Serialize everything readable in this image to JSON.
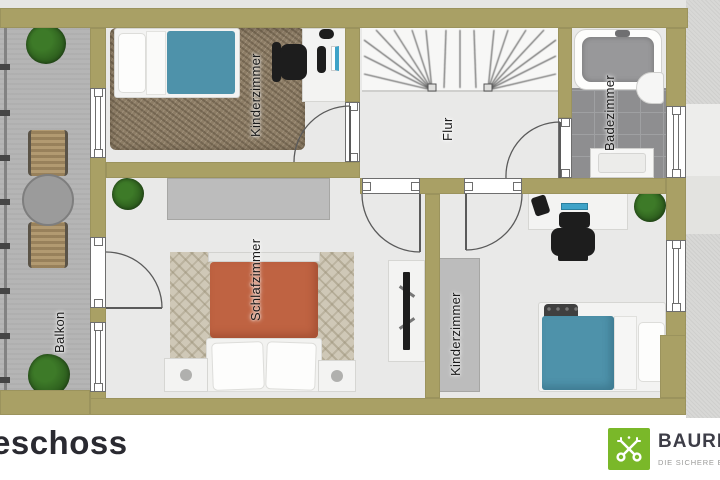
{
  "rooms": {
    "balcony": {
      "label": "Balkon"
    },
    "kids_room_top": {
      "label": "Kinderzimmer"
    },
    "hallway": {
      "label": "Flur"
    },
    "bathroom": {
      "label": "Badezimmer"
    },
    "bedroom": {
      "label": "Schlafzimmer"
    },
    "kids_room_bottom": {
      "label": "Kinderzimmer"
    }
  },
  "footer": {
    "floor_title": "eschoss",
    "logo": {
      "brand": "BAURI",
      "tagline": "DIE SICHERE EI",
      "emblem_icon": "crossed-keys-icon",
      "green": "#7ab829"
    }
  },
  "colors": {
    "wall": "#a9a065",
    "room_floor": "#e9e9e8",
    "balcony_floor": "#b5b5b5",
    "bath_tile": "#8e8e90",
    "carpet_brown": "#8d7d66",
    "rug_beige": "#cfc8b7",
    "blanket_teal": "#4e92aa",
    "blanket_orange": "#bf6342",
    "plant_green": "#2c5c1d",
    "label_text": "#191919",
    "title_text": "#2a2a31"
  }
}
